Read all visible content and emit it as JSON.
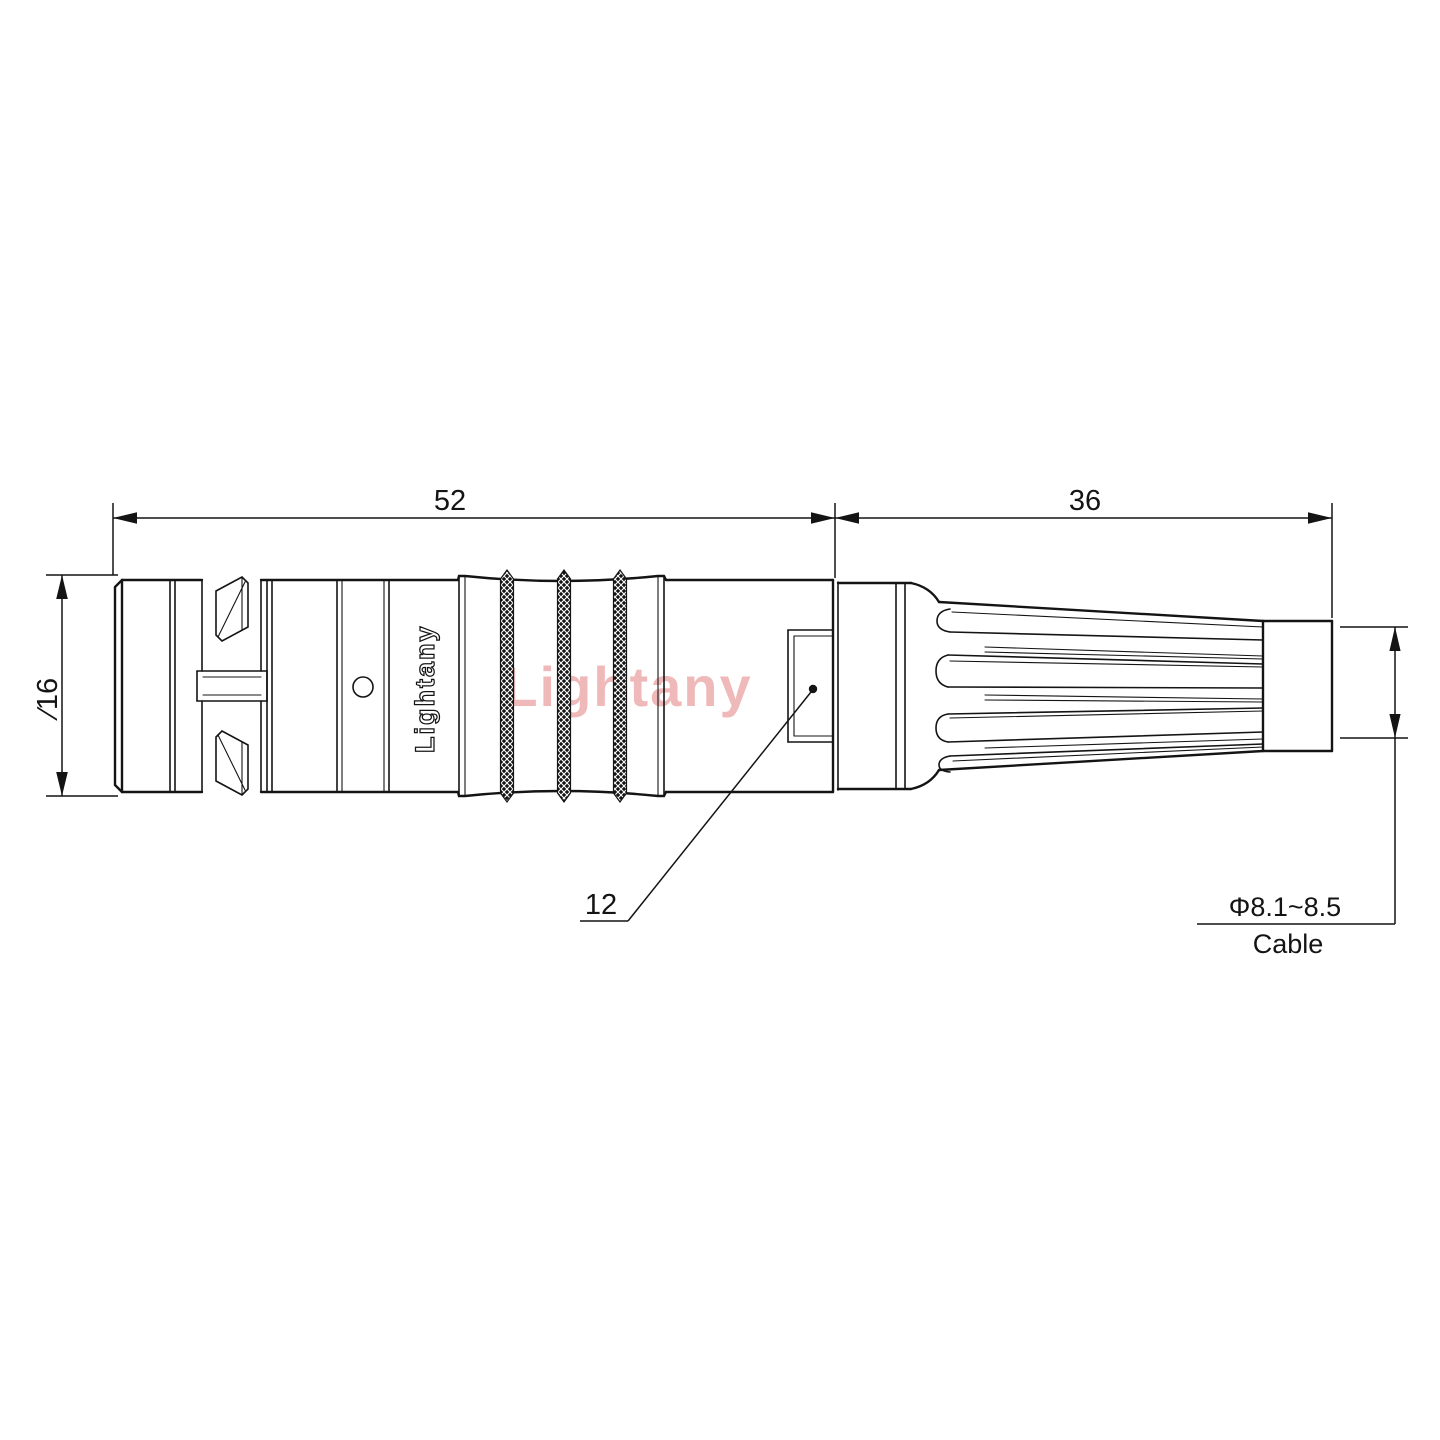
{
  "page": {
    "background": "#ffffff",
    "kind": "connector-dimension-drawing"
  },
  "drawing": {
    "dimensions": {
      "overall_length": "52",
      "boot_length": "36",
      "body_diameter": "∕16",
      "nut_across_flats": "12",
      "cable_range": "Φ8.1~8.5",
      "cable_label": "Cable"
    },
    "branding": {
      "body_marking": "Lightany",
      "watermark": "Lightany"
    },
    "colors": {
      "line": "#141414",
      "watermark_pink": "#efb9b9",
      "background": "#ffffff"
    }
  }
}
